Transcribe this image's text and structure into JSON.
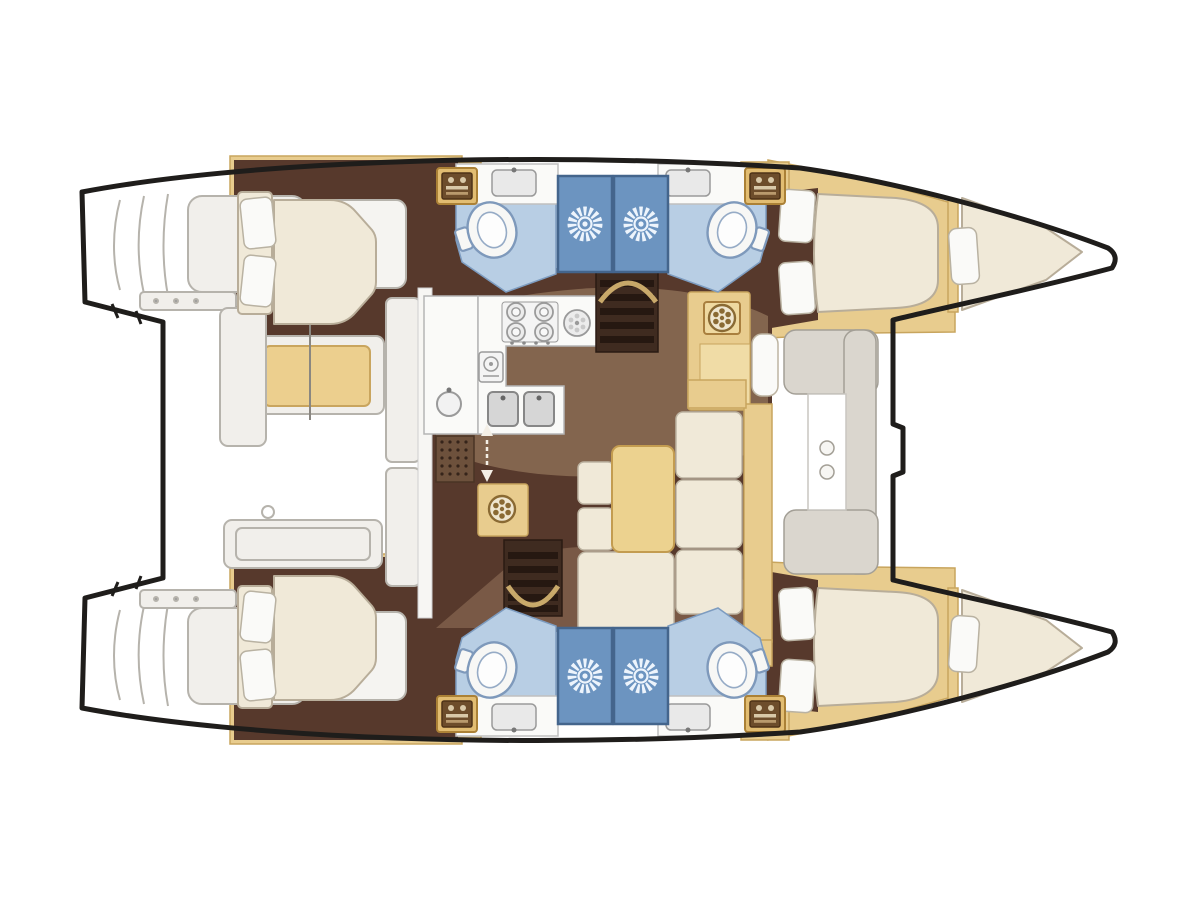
{
  "diagram": {
    "type": "boat-floorplan",
    "subject": "catamaran yacht accommodation / deck plan, top view",
    "orientation": {
      "bow": "right",
      "stern": "left"
    },
    "hulls": [
      {
        "name": "upper hull",
        "rooms": [
          {
            "name": "aft double cabin",
            "fixtures": [
              "island double bed",
              "two pillows",
              "headboard",
              "hanging locker"
            ]
          },
          {
            "name": "aft head",
            "fixtures": [
              "wash basin",
              "toilet",
              "shower stall with drain rose"
            ]
          },
          {
            "name": "forward head",
            "fixtures": [
              "wash basin",
              "toilet",
              "shower stall with drain rose"
            ]
          },
          {
            "name": "forward double cabin",
            "fixtures": [
              "double bed",
              "two pillows",
              "hanging locker"
            ]
          },
          {
            "name": "bow berth",
            "fixtures": [
              "tapered single berth",
              "pillow"
            ]
          },
          {
            "name": "transom steps",
            "fixtures": [
              "swim steps"
            ]
          }
        ]
      },
      {
        "name": "lower hull",
        "rooms": [
          {
            "name": "aft double cabin",
            "fixtures": [
              "island double bed",
              "two pillows",
              "headboard",
              "hanging locker"
            ]
          },
          {
            "name": "aft head",
            "fixtures": [
              "wash basin",
              "toilet",
              "shower stall with drain rose"
            ]
          },
          {
            "name": "forward head",
            "fixtures": [
              "wash basin",
              "toilet",
              "shower stall with drain rose"
            ]
          },
          {
            "name": "forward double cabin",
            "fixtures": [
              "double bed",
              "two pillows",
              "hanging locker"
            ]
          },
          {
            "name": "bow berth",
            "fixtures": [
              "tapered single berth",
              "pillow"
            ]
          },
          {
            "name": "transom steps",
            "fixtures": [
              "swim steps"
            ]
          }
        ]
      }
    ],
    "bridgedeck": {
      "rooms": [
        {
          "name": "galley",
          "fixtures": [
            "4-burner hob",
            "auxiliary ring burner",
            "oven dial unit",
            "double sink",
            "round sink",
            "floor grate",
            "companionway arrows"
          ]
        },
        {
          "name": "saloon dinette",
          "fixtures": [
            "rectangular table",
            "L-shaped settee",
            "seat cushions"
          ]
        },
        {
          "name": "nav cabinet",
          "fixtures": [
            "appliance dial",
            "seat cushion"
          ]
        },
        {
          "name": "washer cabinet",
          "fixtures": [
            "front-load dial"
          ]
        },
        {
          "name": "companionway stairs to upper hull",
          "fixtures": [
            "5 steps",
            "handrail"
          ]
        },
        {
          "name": "companionway stairs to lower hull",
          "fixtures": [
            "5 steps",
            "handrail"
          ]
        },
        {
          "name": "aft cockpit",
          "fixtures": [
            "bench with cushion",
            "side panel",
            "stern bench",
            "locker panels"
          ]
        },
        {
          "name": "forward cockpit",
          "fixtures": [
            "C-shaped lounge seat",
            "two cup holders",
            "access door in beam"
          ]
        }
      ]
    },
    "counts": {
      "hulls": 2,
      "double_cabins": 4,
      "bow_berths": 2,
      "heads": 4,
      "shower_stalls": 4,
      "toilets": 4,
      "wash_basins": 4,
      "hanging_lockers": 4,
      "hob_burners": 4,
      "companionway_stairs": 2
    }
  },
  "colors": {
    "outline": "#1F1D1B",
    "hull_fill": "#FFFFFF",
    "floor_dark": "#57392C",
    "floor_light": "#8F7058",
    "wood": "#E8CC8E",
    "wood_dark": "#C8A55E",
    "wood_light": "#F0DCA6",
    "cushion": "#F0E9D8",
    "cushion_edge": "#B8AD99",
    "white_surface": "#FAFAF8",
    "counter_edge": "#B5B5B5",
    "bath_floor": "#B8CEE4",
    "bath_edge": "#7D9CC0",
    "shower": "#6C94C0",
    "shower_edge": "#44658C",
    "sun": "#EDF4FC",
    "toilet_outline": "#7E99BB",
    "sketch": "#B6B3AC",
    "deck_cushion": "#DAD6CE",
    "stairs": "#3F2B20",
    "stair_bar": "#261811",
    "grate": "#6D513C",
    "grate_dot": "#35241A",
    "table": "#ECD28F",
    "bench_cushion": "#ECCF8E",
    "rail": "#D9B873",
    "appliance_line": "#9A9A9A"
  }
}
